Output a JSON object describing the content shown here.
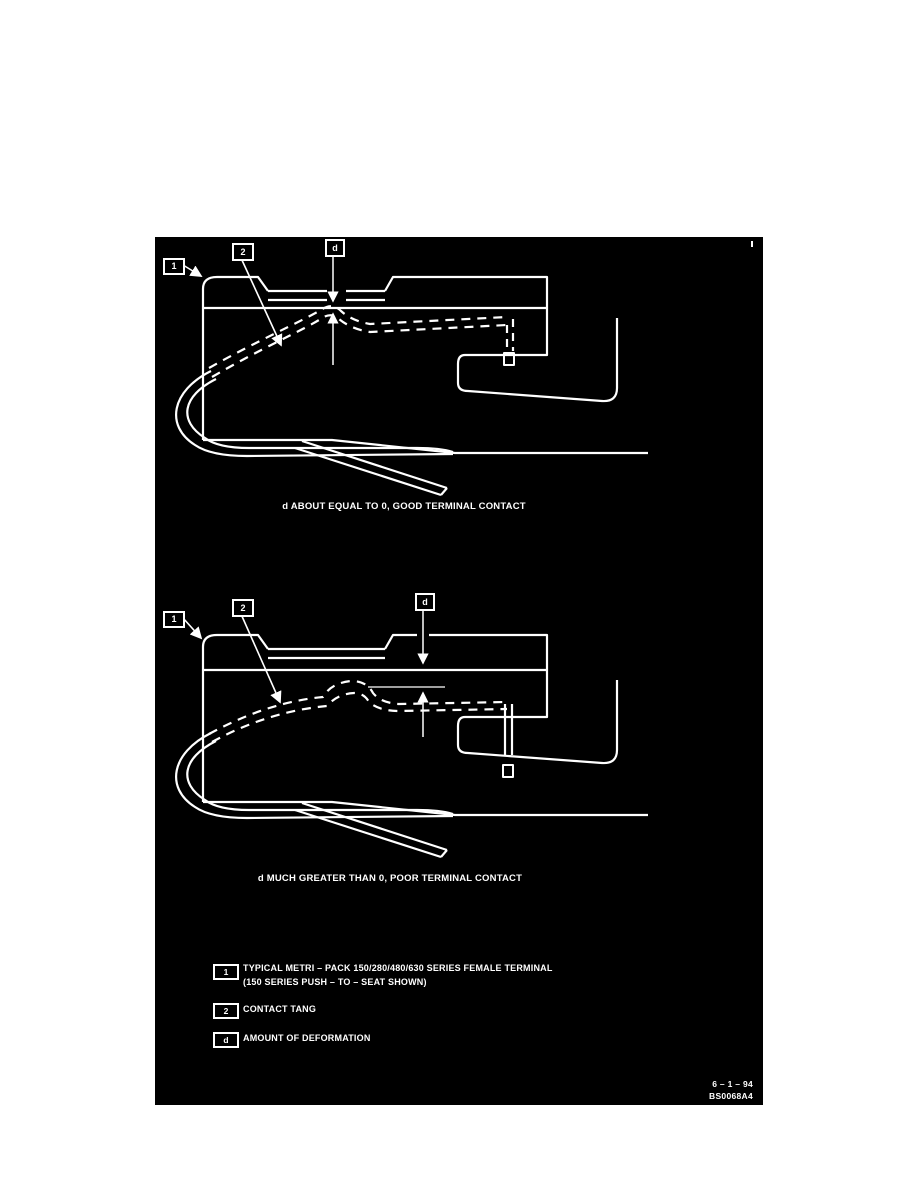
{
  "colors": {
    "page_bg": "#ffffff",
    "panel_bg": "#000000",
    "ink": "#ffffff"
  },
  "diagram_top": {
    "callouts": {
      "c1": "1",
      "c2": "2",
      "cd": "d"
    },
    "caption": "d ABOUT EQUAL TO 0, GOOD TERMINAL CONTACT"
  },
  "diagram_bottom": {
    "callouts": {
      "c1": "1",
      "c2": "2",
      "cd": "d"
    },
    "caption": "d MUCH GREATER THAN 0, POOR TERMINAL CONTACT"
  },
  "legend": {
    "items": [
      {
        "key": "1",
        "line1": "TYPICAL METRI – PACK 150/280/480/630 SERIES FEMALE TERMINAL",
        "line2": "(150 SERIES PUSH – TO – SEAT SHOWN)"
      },
      {
        "key": "2",
        "line1": "CONTACT TANG",
        "line2": ""
      },
      {
        "key": "d",
        "line1": "AMOUNT OF DEFORMATION",
        "line2": ""
      }
    ]
  },
  "footer": {
    "date": "6 – 1 – 94",
    "code": "BS0068A4"
  }
}
